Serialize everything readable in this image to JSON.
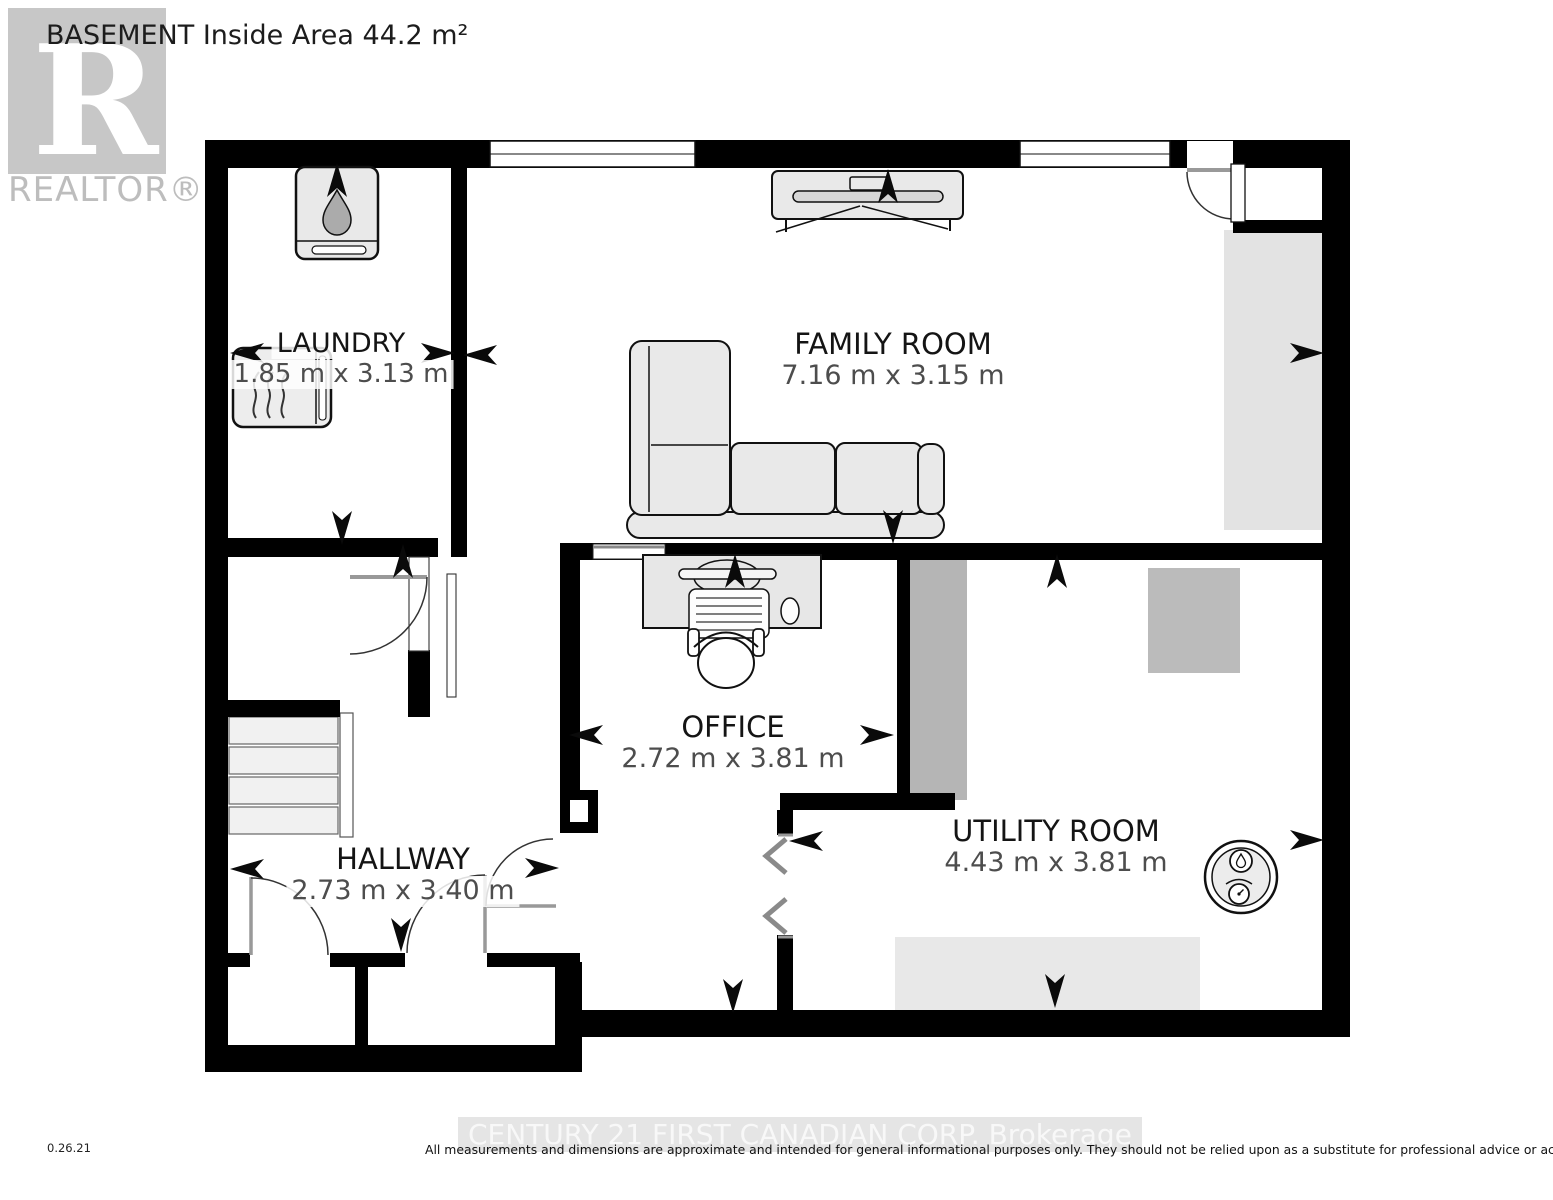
{
  "title": "BASEMENT Inside Area 44.2 m²",
  "realtor": {
    "logo_letter": "R",
    "label": "REALTOR®"
  },
  "rooms": {
    "laundry": {
      "name": "LAUNDRY",
      "dimensions": "1.85 m x 3.13 m"
    },
    "family_room": {
      "name": "FAMILY ROOM",
      "dimensions": "7.16 m x 3.15 m"
    },
    "office": {
      "name": "OFFICE",
      "dimensions": "2.72 m x 3.81 m"
    },
    "hallway": {
      "name": "HALLWAY",
      "dimensions": "2.73 m x 3.40 m"
    },
    "utility_room": {
      "name": "UTILITY ROOM",
      "dimensions": "4.43 m x 3.81 m"
    }
  },
  "footer": {
    "version": "0.26.21",
    "watermark": "CENTURY 21 FIRST CANADIAN CORP. Brokerage",
    "disclaimer": "All measurements and dimensions are approximate and intended for general informational purposes only. They should not be relied upon as a substitute for professional advice or accurate surveying."
  },
  "icons": {
    "water_heater": "rounded-square-with-water-drop",
    "washer": "square-with-steam-lines",
    "tv": "media-console-top-view",
    "sofa": "l-shaped-sectional-top-view",
    "desk": "desk-with-keyboard-monitor-and-chair",
    "hot_water_tank": "circle-with-drop-and-gauge",
    "direction_arrow": "black-chevron-arrow"
  },
  "colors": {
    "wall": "#000000",
    "furniture_fill": "#e9e9e9",
    "floor_feature_dark": "#b5b5b5",
    "floor_feature_light": "#e3e3e3",
    "dimension_text": "#4d4d4d",
    "watermark_gray": "#c7c7c7"
  },
  "arrows": [
    {
      "x": 247,
      "y": 353,
      "r": 180
    },
    {
      "x": 438,
      "y": 353,
      "r": 0
    },
    {
      "x": 337,
      "y": 180,
      "r": 270
    },
    {
      "x": 342,
      "y": 528,
      "r": 90
    },
    {
      "x": 480,
      "y": 355,
      "r": 180
    },
    {
      "x": 1307,
      "y": 353,
      "r": 0
    },
    {
      "x": 888,
      "y": 186,
      "r": 270
    },
    {
      "x": 893,
      "y": 527,
      "r": 90
    },
    {
      "x": 586,
      "y": 735,
      "r": 180
    },
    {
      "x": 877,
      "y": 735,
      "r": 0
    },
    {
      "x": 735,
      "y": 571,
      "r": 270
    },
    {
      "x": 733,
      "y": 996,
      "r": 90
    },
    {
      "x": 247,
      "y": 869,
      "r": 180
    },
    {
      "x": 542,
      "y": 868,
      "r": 0
    },
    {
      "x": 403,
      "y": 561,
      "r": 270
    },
    {
      "x": 401,
      "y": 935,
      "r": 90
    },
    {
      "x": 806,
      "y": 841,
      "r": 180
    },
    {
      "x": 1307,
      "y": 840,
      "r": 0
    },
    {
      "x": 1057,
      "y": 571,
      "r": 270
    },
    {
      "x": 1055,
      "y": 991,
      "r": 90
    }
  ]
}
